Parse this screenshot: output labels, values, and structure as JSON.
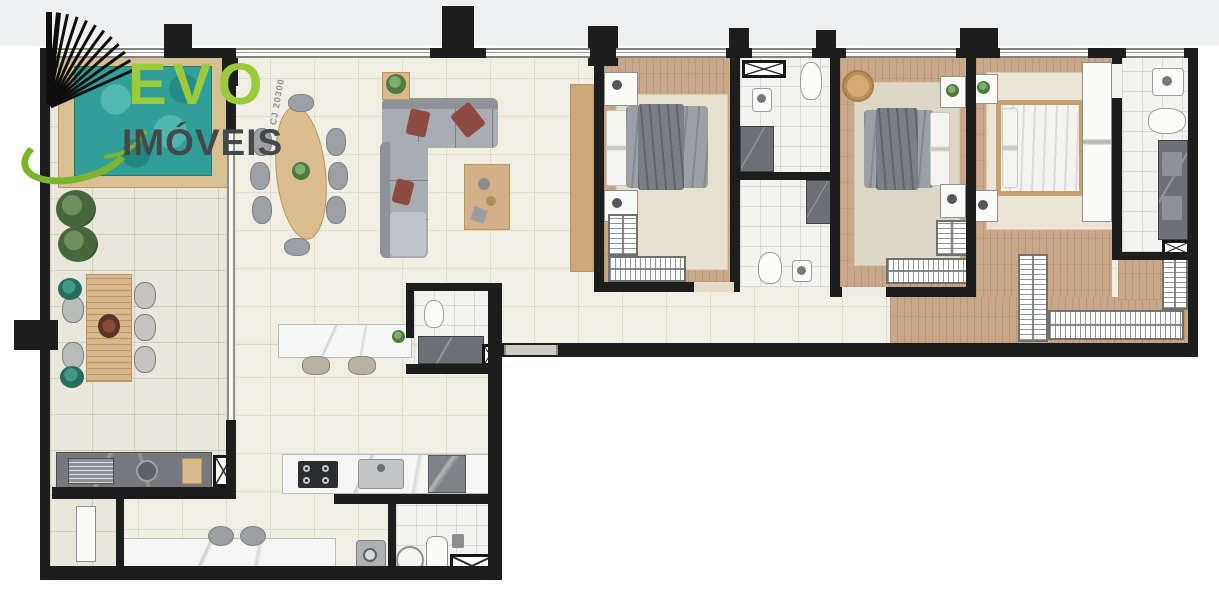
{
  "logo": {
    "brand": "EVO",
    "subtitle": "IMÓVEIS",
    "brand_color": "#9bcb3c",
    "subtitle_color": "#45484b",
    "swoosh_color": "#7cb42e",
    "building_bars_color": "#0e0e0e"
  },
  "watermark": {
    "text": "CJ 20300",
    "color": "#8b9094"
  },
  "palette": {
    "wall": "#1d1d1d",
    "living_tile": "#f1eee4",
    "terrace_tile": "#e9e6db",
    "wood_floor": "#c9a88a",
    "bath_floor": "#f2f2ee",
    "pool_water": "#2f9f98",
    "deck_wood": "#d8c093",
    "marble_counter": "#f6f6f7",
    "dark_stone_counter": "#75797d",
    "rug": "#e7e1d1",
    "sofa_gray": "#9da0a4",
    "accent_pillow": "#8c4a42",
    "bed_duvet_gray": "#9ba0a5",
    "master_bed_white": "#f4f3ef"
  },
  "rooms": [
    {
      "name": "terrace",
      "items": [
        "pool",
        "pool-deck",
        "outdoor-dining-table",
        "outdoor-chairs",
        "plants",
        "gourmet-counter",
        "grill",
        "round-sink",
        "duct-shaft"
      ]
    },
    {
      "name": "living-dining",
      "items": [
        "oval-dining-table",
        "dining-chairs",
        "sectional-sofa",
        "accent-pillows",
        "coffee-table",
        "side-table-plant",
        "tv-panel"
      ]
    },
    {
      "name": "kitchen",
      "items": [
        "island-counter",
        "bar-stools",
        "cooktop",
        "kitchen-sink",
        "refrigerator",
        "lower-counter"
      ]
    },
    {
      "name": "powder-room",
      "items": [
        "toilet",
        "shower-box",
        "duct-shaft"
      ]
    },
    {
      "name": "laundry-service",
      "items": [
        "washing-machine",
        "laundry-tub",
        "water-heater",
        "duct-shaft",
        "service-door"
      ]
    },
    {
      "name": "bedroom-1",
      "items": [
        "double-bed-gray",
        "nightstands",
        "rug",
        "wardrobes"
      ]
    },
    {
      "name": "bathroom-1",
      "items": [
        "sink",
        "toilet",
        "shower-box",
        "duct-shaft"
      ]
    },
    {
      "name": "bathroom-2",
      "items": [
        "sink",
        "toilet",
        "shower-box"
      ]
    },
    {
      "name": "bedroom-2",
      "items": [
        "double-bed-gray",
        "nightstands",
        "rug",
        "wardrobes",
        "wicker-chair"
      ]
    },
    {
      "name": "corridor",
      "items": [
        "entry-door-opening"
      ]
    },
    {
      "name": "master-bedroom",
      "items": [
        "double-bed-white",
        "nightstands",
        "rug",
        "wardrobe-panel"
      ]
    },
    {
      "name": "master-closet",
      "items": [
        "wardrobes"
      ]
    },
    {
      "name": "master-bathroom",
      "items": [
        "sink",
        "toilet",
        "double-shower",
        "duct-shaft"
      ]
    }
  ]
}
